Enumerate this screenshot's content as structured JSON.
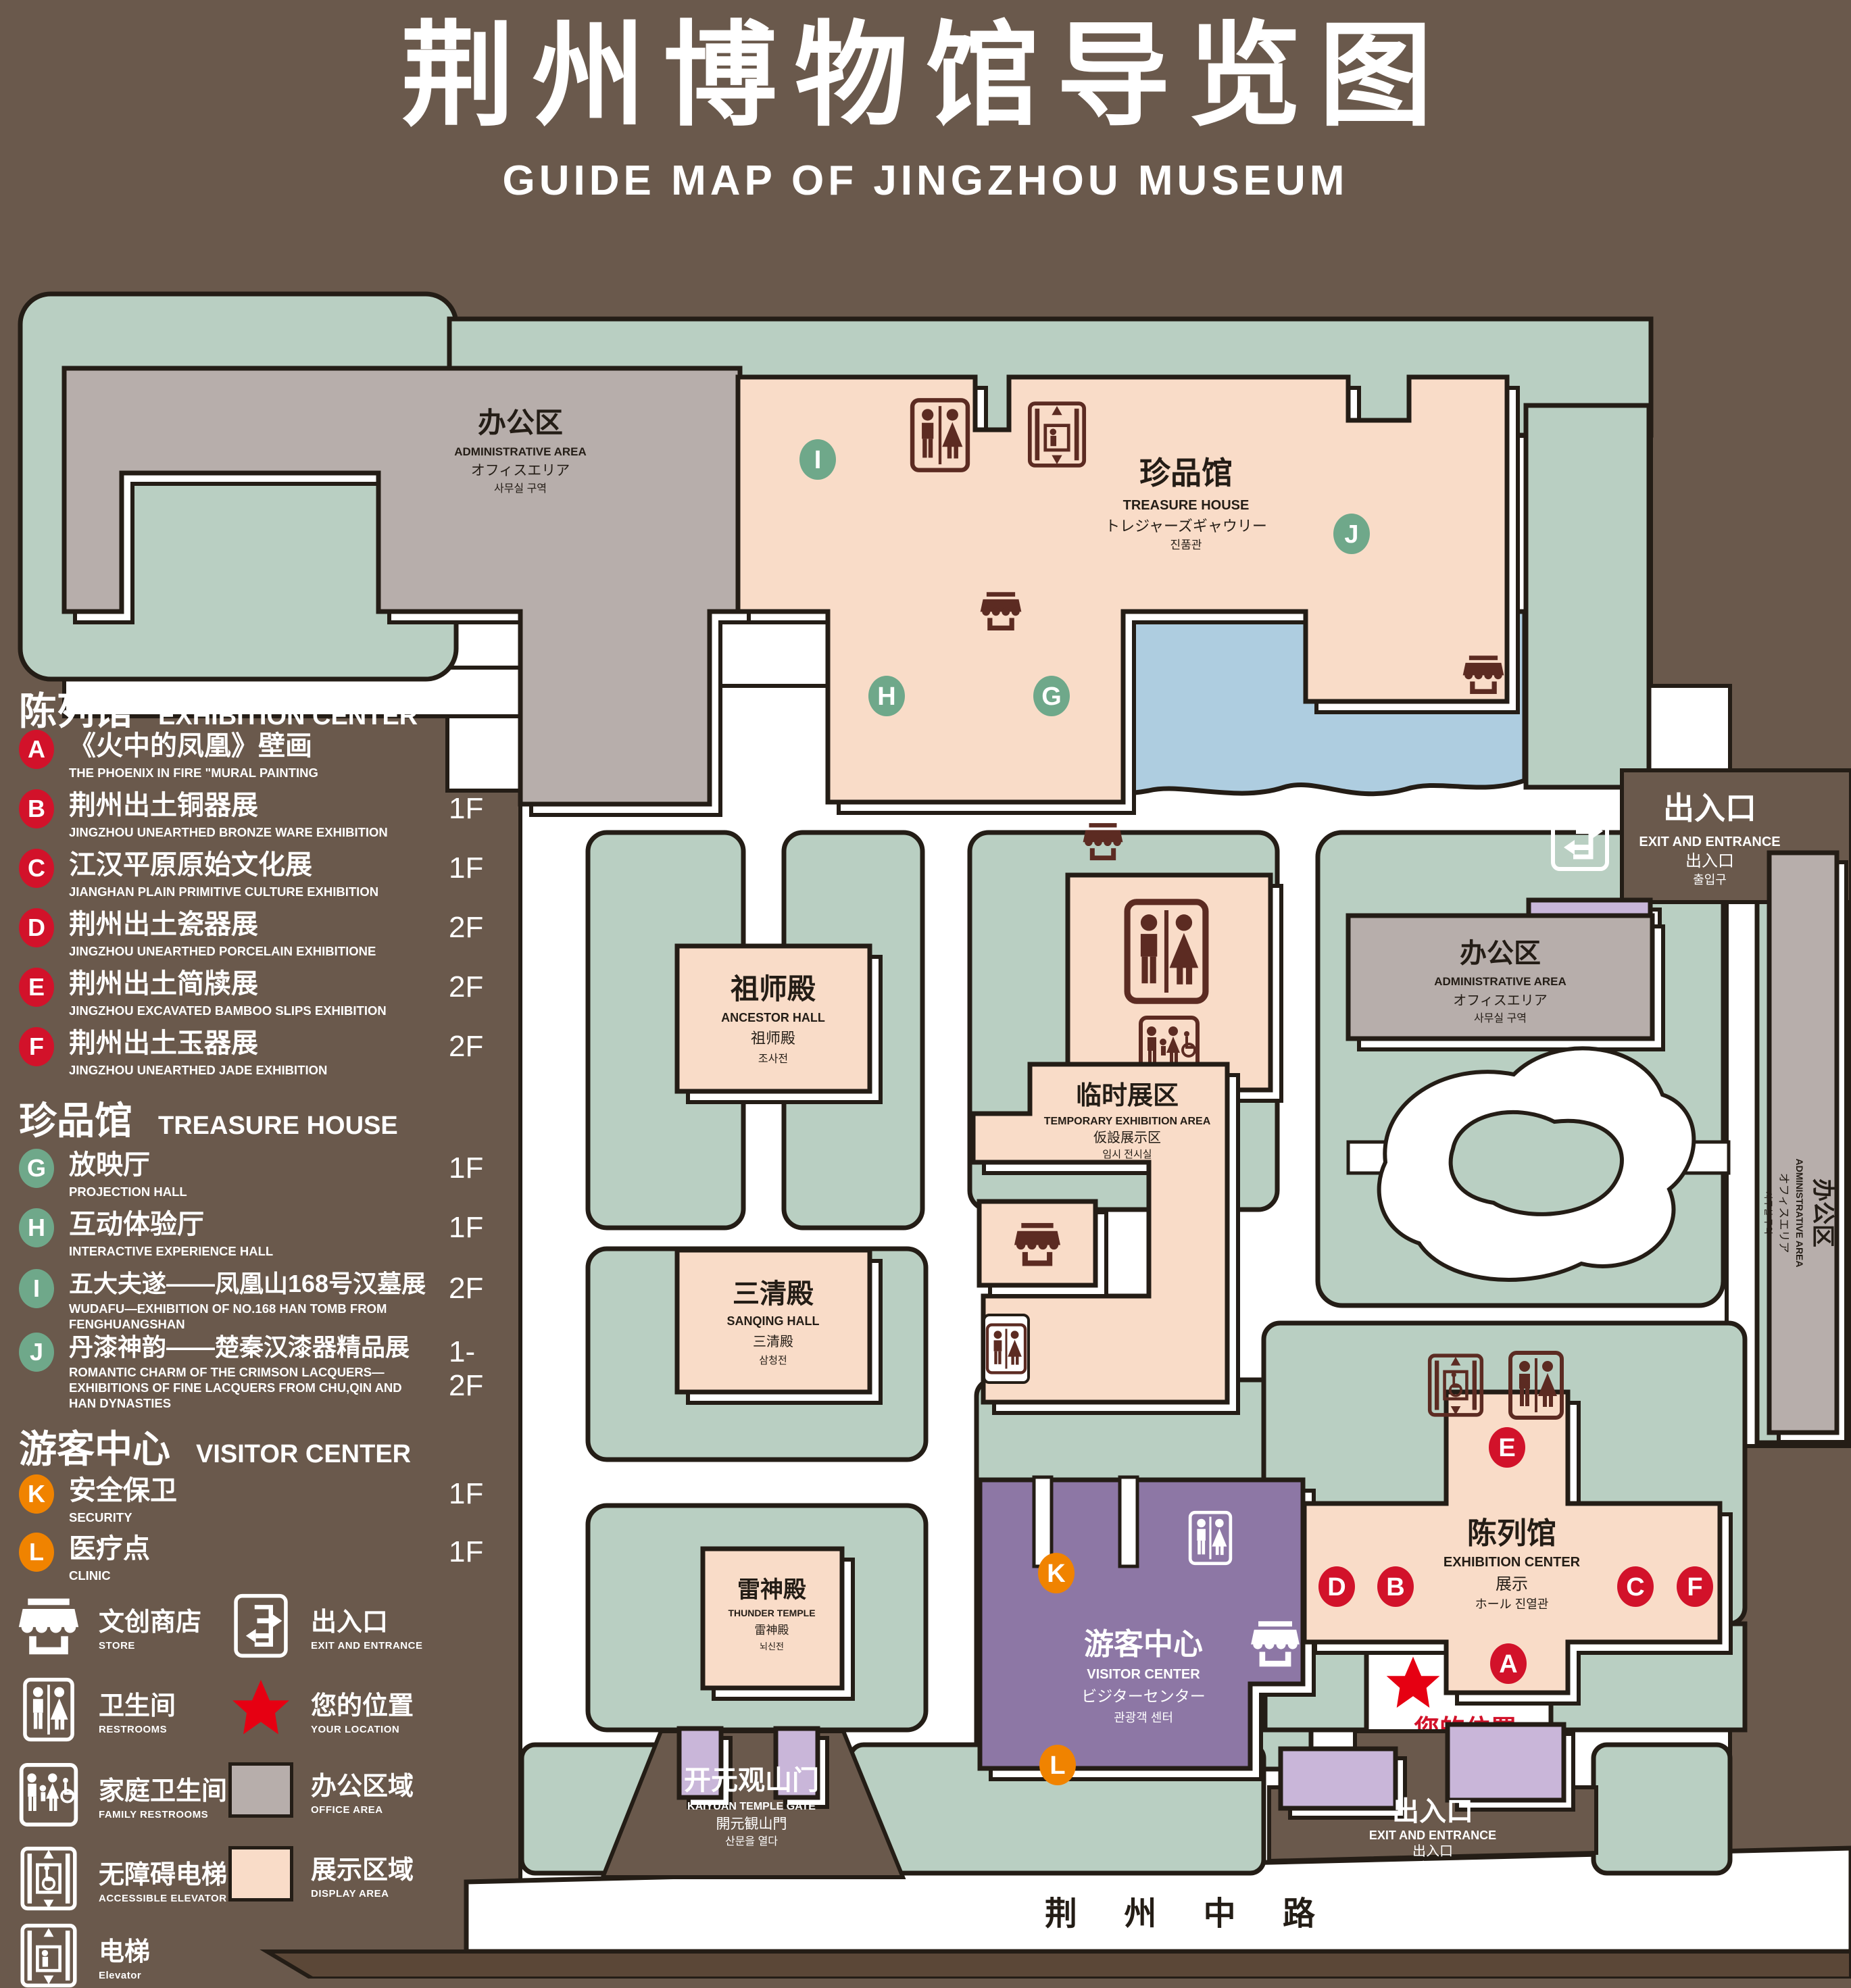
{
  "title": {
    "zh": "荆州博物馆导览图",
    "en": "GUIDE MAP OF JINGZHOU MUSEUM"
  },
  "colors": {
    "bg": "#6a594c",
    "roadstrip": "#5b4737",
    "outline": "#241d16",
    "green": "#b9cfc2",
    "pink": "#f9dcc8",
    "gray": "#b7aeab",
    "blue": "#aecde0",
    "purple": "#8d77a5",
    "lavender": "#c9b6d9",
    "red": "#d2122a",
    "badgegreen": "#6fa88a",
    "orange": "#f08300",
    "maroon": "#5c2b22",
    "locred": "#e60012"
  },
  "legend": {
    "sections": [
      {
        "zh": "陈列馆",
        "en": "EXHIBITION CENTER",
        "items": [
          {
            "letter": "A",
            "zh": "《火中的凤凰》壁画",
            "en": "THE PHOENIX IN FIRE \"MURAL PAINTING",
            "floor": "1F"
          },
          {
            "letter": "B",
            "zh": "荆州出土铜器展",
            "en": "JINGZHOU UNEARTHED BRONZE WARE EXHIBITION",
            "floor": "1F"
          },
          {
            "letter": "C",
            "zh": "江汉平原原始文化展",
            "en": "JIANGHAN PLAIN PRIMITIVE CULTURE EXHIBITION",
            "floor": "1F"
          },
          {
            "letter": "D",
            "zh": "荆州出土瓷器展",
            "en": "JINGZHOU UNEARTHED PORCELAIN EXHIBITIONE",
            "floor": "2F"
          },
          {
            "letter": "E",
            "zh": "荆州出土简牍展",
            "en": "JINGZHOU EXCAVATED BAMBOO SLIPS EXHIBITION",
            "floor": "2F"
          },
          {
            "letter": "F",
            "zh": "荆州出土玉器展",
            "en": "JINGZHOU UNEARTHED JADE EXHIBITION",
            "floor": "2F"
          }
        ]
      },
      {
        "zh": "珍品馆",
        "en": "TREASURE HOUSE",
        "items": [
          {
            "letter": "G",
            "zh": "放映厅",
            "en": "PROJECTION HALL",
            "floor": "1F"
          },
          {
            "letter": "H",
            "zh": "互动体验厅",
            "en": "INTERACTIVE EXPERIENCE HALL",
            "floor": "1F"
          },
          {
            "letter": "I",
            "zh": "五大夫遂——凤凰山168号汉墓展",
            "en": "WUDAFU—EXHIBITION OF NO.168 HAN TOMB FROM FENGHUANGSHAN",
            "floor": "2F"
          },
          {
            "letter": "J",
            "zh": "丹漆神韵——楚秦汉漆器精品展",
            "en": "ROMANTIC CHARM OF THE CRIMSON LACQUERS—EXHIBITIONS OF FINE LACQUERS FROM CHU,QIN AND HAN DYNASTIES",
            "floor": "1-2F"
          }
        ]
      },
      {
        "zh": "游客中心",
        "en": "VISITOR CENTER",
        "items": [
          {
            "letter": "K",
            "zh": "安全保卫",
            "en": "SECURITY",
            "floor": "1F"
          },
          {
            "letter": "L",
            "zh": "医疗点",
            "en": "CLINIC",
            "floor": "1F"
          }
        ]
      }
    ],
    "symbols": {
      "store": {
        "zh": "文创商店",
        "en": "STORE"
      },
      "restrooms": {
        "zh": "卫生间",
        "en": "RESTROOMS"
      },
      "family": {
        "zh": "家庭卫生间",
        "en": "FAMILY RESTROOMS"
      },
      "accessible": {
        "zh": "无障碍电梯",
        "en": "ACCESSIBLE ELEVATOR"
      },
      "elevator": {
        "zh": "电梯",
        "en": "Elevator"
      },
      "exit": {
        "zh": "出入口",
        "en": "EXIT AND ENTRANCE"
      },
      "location": {
        "zh": "您的位置",
        "en": "YOUR LOCATION"
      },
      "office": {
        "zh": "办公区域",
        "en": "OFFICE AREA"
      },
      "display": {
        "zh": "展示区域",
        "en": "DISPLAY AREA"
      }
    }
  },
  "map": {
    "admin_nw": {
      "zh": "办公区",
      "en": "ADMINISTRATIVE AREA",
      "ja": "オフィスエリア",
      "ko": "사무실 구역"
    },
    "treasure": {
      "zh": "珍品馆",
      "en": "TREASURE HOUSE",
      "ja": "トレジャーズギャウリー",
      "ko": "진품관"
    },
    "exit_ne": {
      "zh": "出入口",
      "en": "EXIT AND ENTRANCE",
      "ja": "出入口",
      "ko": "출입구"
    },
    "ancestor": {
      "zh": "祖师殿",
      "en": "ANCESTOR HALL",
      "ja": "祖师殿",
      "ko": "조사전"
    },
    "temporary": {
      "zh": "临时展区",
      "en": "TEMPORARY EXHIBITION AREA",
      "ja": "仮設展示区",
      "ko": "임시 전시실"
    },
    "admin_e": {
      "zh": "办公区",
      "en": "ADMINISTRATIVE AREA",
      "ja": "オフィスエリア",
      "ko": "사무실 구역"
    },
    "sanqing": {
      "zh": "三清殿",
      "en": "SANQING HALL",
      "ja": "三清殿",
      "ko": "삼청전"
    },
    "thunder": {
      "zh": "雷神殿",
      "en": "THUNDER TEMPLE",
      "ja": "雷神殿",
      "ko": "뇌신전"
    },
    "visitor": {
      "zh": "游客中心",
      "en": "VISITOR CENTER",
      "ja": "ビジターセンター",
      "ko": "관광객 센터"
    },
    "exhibition": {
      "zh": "陈列馆",
      "en": "EXHIBITION CENTER",
      "ja": "展示",
      "ko": "ホール 진열관"
    },
    "admin_strip": {
      "zh": "办公区",
      "en": "ADMINISTRATIVE AREA",
      "ja": "オフィスエリア",
      "ko": "사무실 구역"
    },
    "gate": {
      "zh": "开元观山门",
      "en": "KAIYUAN TEMPLE GATE",
      "ja": "開元観山門",
      "ko": "산문을 열다"
    },
    "exit_s": {
      "zh": "出入口",
      "en": "EXIT AND ENTRANCE",
      "ja": "出入口",
      "ko": "출입구"
    },
    "road": "荆 州 中 路",
    "your_location": "您的位置",
    "badges": {
      "a": "A",
      "b": "B",
      "c": "C",
      "d": "D",
      "e": "E",
      "f": "F",
      "g": "G",
      "h": "H",
      "i": "I",
      "j": "J",
      "k": "K",
      "l": "L"
    }
  }
}
